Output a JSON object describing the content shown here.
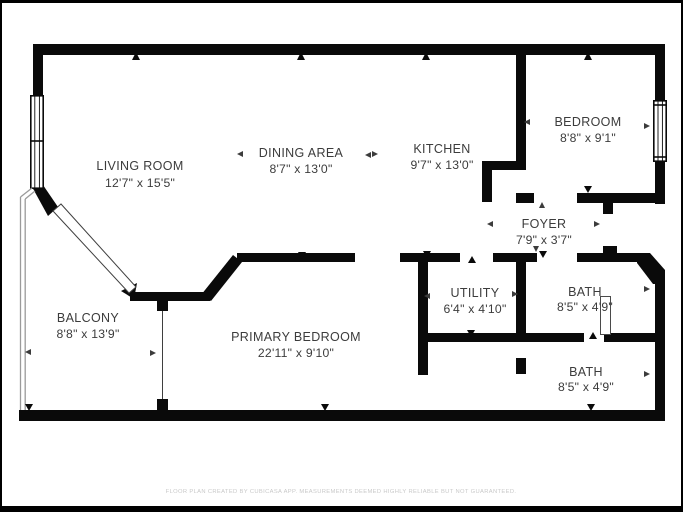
{
  "colors": {
    "background": "#ffffff",
    "wall": "#0a0a0a",
    "balcony_outline": "#9a9a9a",
    "door_line": "#3f3f3f",
    "fixture": "#4a4a4a",
    "label": "#3c3c3c",
    "footer_text": "#c9c9c9",
    "frame": "#000000"
  },
  "rooms": [
    {
      "name": "LIVING ROOM",
      "dims": "12'7\" x 15'5\""
    },
    {
      "name": "DINING AREA",
      "dims": "8'7\" x 13'0\""
    },
    {
      "name": "KITCHEN",
      "dims": "9'7\" x 13'0\""
    },
    {
      "name": "BEDROOM",
      "dims": "8'8\" x 9'1\""
    },
    {
      "name": "FOYER",
      "dims": "7'9\" x 3'7\""
    },
    {
      "name": "BALCONY",
      "dims": "8'8\" x 13'9\""
    },
    {
      "name": "PRIMARY BEDROOM",
      "dims": "22'11\" x 9'10\""
    },
    {
      "name": "UTILITY",
      "dims": "6'4\" x 4'10\""
    },
    {
      "name": "BATH",
      "dims": "8'5\" x 4'9\""
    },
    {
      "name": "BATH",
      "dims": "8'5\" x 4'9\""
    }
  ],
  "footer": {
    "text": "FLOOR PLAN CREATED BY CUBICASA APP. MEASUREMENTS DEEMED HIGHLY RELIABLE BUT NOT GUARANTEED."
  }
}
